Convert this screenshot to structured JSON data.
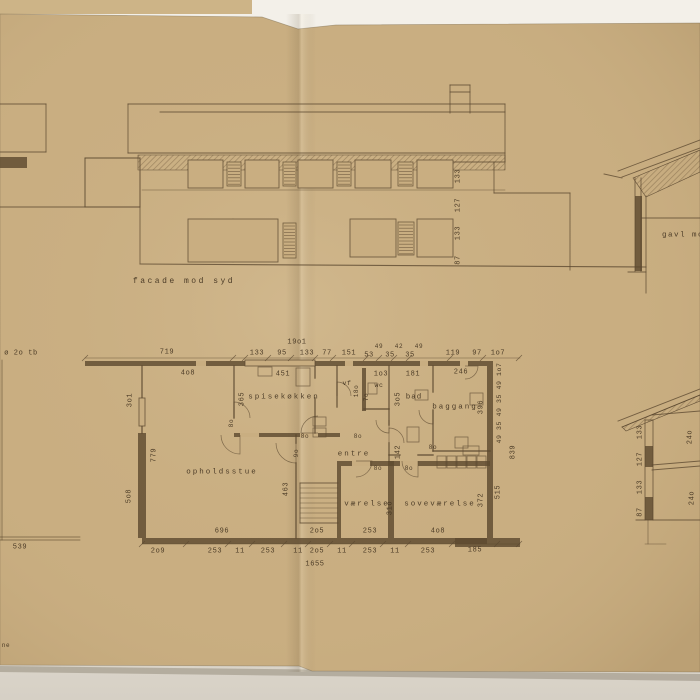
{
  "document": {
    "kind": "scanned architectural drawing on folded tracing paper",
    "captions": {
      "facade": "facade mod syd",
      "gavl": "gavl mod",
      "note_left": "ø 2o tb",
      "note_bottom_left": "ne"
    },
    "rooms": [
      "spisekøkken",
      "opholdsstue",
      "entre",
      "værelse",
      "soveværelse",
      "bad",
      "wc",
      "vf",
      "baggang"
    ]
  },
  "colors": {
    "ink": "#5b4830",
    "wall": "#5e4a2f",
    "paper": "#c9ae81",
    "paper_edge": "#b89c6f",
    "backing_strip": "#cdb487",
    "bg_top": "#f3f0e9",
    "bg_bottom": "#dcd6cb"
  },
  "labels": [
    {
      "t": "facade mod syd",
      "x": 184,
      "y": 282,
      "s": 8,
      "ls": 2.5,
      "n": "facade-caption"
    },
    {
      "t": "gavl mod",
      "x": 686,
      "y": 236,
      "s": 7.5,
      "ls": 1.5,
      "n": "gavl-caption"
    },
    {
      "t": "ø 2o tb",
      "x": 21,
      "y": 354,
      "s": 7,
      "n": "note-left"
    },
    {
      "t": "ne",
      "x": 6,
      "y": 646,
      "s": 6,
      "n": "note-bottom-left"
    },
    {
      "t": "539",
      "x": 20,
      "y": 548,
      "n": "dim-539"
    },
    {
      "t": "133",
      "x": 459,
      "y": 176,
      "r": 1
    },
    {
      "t": "127",
      "x": 459,
      "y": 205,
      "r": 1
    },
    {
      "t": "133",
      "x": 459,
      "y": 233,
      "r": 1
    },
    {
      "t": "87",
      "x": 459,
      "y": 260,
      "r": 1
    },
    {
      "t": "133",
      "x": 641,
      "y": 432,
      "r": 1
    },
    {
      "t": "127",
      "x": 641,
      "y": 459,
      "r": 1
    },
    {
      "t": "133",
      "x": 641,
      "y": 487,
      "r": 1
    },
    {
      "t": "87",
      "x": 641,
      "y": 512,
      "r": 1
    },
    {
      "t": "24o",
      "x": 691,
      "y": 437,
      "r": 1
    },
    {
      "t": "24o",
      "x": 693,
      "y": 498,
      "r": 1
    },
    {
      "t": "19o1",
      "x": 297,
      "y": 343
    },
    {
      "t": "719",
      "x": 167,
      "y": 353
    },
    {
      "t": "133",
      "x": 257,
      "y": 354
    },
    {
      "t": "95",
      "x": 282,
      "y": 354
    },
    {
      "t": "133",
      "x": 307,
      "y": 354
    },
    {
      "t": "77",
      "x": 327,
      "y": 354
    },
    {
      "t": "151",
      "x": 349,
      "y": 354
    },
    {
      "t": "53",
      "x": 369,
      "y": 356
    },
    {
      "t": "49",
      "x": 379,
      "y": 347,
      "s": 6
    },
    {
      "t": "35",
      "x": 390,
      "y": 356
    },
    {
      "t": "42",
      "x": 399,
      "y": 347,
      "s": 6
    },
    {
      "t": "35",
      "x": 410,
      "y": 356
    },
    {
      "t": "49",
      "x": 419,
      "y": 347,
      "s": 6
    },
    {
      "t": "119",
      "x": 453,
      "y": 354
    },
    {
      "t": "97",
      "x": 477,
      "y": 354
    },
    {
      "t": "1o7",
      "x": 498,
      "y": 354
    },
    {
      "t": "4o8",
      "x": 188,
      "y": 374
    },
    {
      "t": "3o1",
      "x": 131,
      "y": 400,
      "r": 1
    },
    {
      "t": "451",
      "x": 283,
      "y": 375
    },
    {
      "t": "365",
      "x": 243,
      "y": 399,
      "r": 1
    },
    {
      "t": "spisekøkken",
      "x": 284,
      "y": 398,
      "s": 7.5,
      "ls": 2,
      "n": "room-label-spisekokken"
    },
    {
      "t": "vf",
      "x": 347,
      "y": 384,
      "s": 6.5,
      "n": "room-label-vf"
    },
    {
      "t": "18o",
      "x": 357,
      "y": 391,
      "r": 1,
      "s": 6
    },
    {
      "t": "7o",
      "x": 367,
      "y": 397,
      "r": 1,
      "s": 6
    },
    {
      "t": "1o3",
      "x": 381,
      "y": 375
    },
    {
      "t": "wc",
      "x": 379,
      "y": 386,
      "s": 6.5,
      "n": "room-label-wc"
    },
    {
      "t": "181",
      "x": 413,
      "y": 375
    },
    {
      "t": "3o5",
      "x": 399,
      "y": 399,
      "r": 1
    },
    {
      "t": "bad",
      "x": 414,
      "y": 398,
      "s": 7.5,
      "ls": 1,
      "n": "room-label-bad"
    },
    {
      "t": "246",
      "x": 461,
      "y": 373
    },
    {
      "t": "baggang",
      "x": 455,
      "y": 408,
      "s": 7.5,
      "ls": 2,
      "n": "room-label-baggang"
    },
    {
      "t": "396",
      "x": 482,
      "y": 407,
      "r": 1
    },
    {
      "t": "49 35 49 35 49 1o7",
      "x": 500,
      "y": 403,
      "r": 1,
      "s": 6.5
    },
    {
      "t": "839",
      "x": 514,
      "y": 452,
      "r": 1
    },
    {
      "t": "opholdsstue",
      "x": 222,
      "y": 473,
      "s": 7.5,
      "ls": 2,
      "n": "room-label-opholdsstue"
    },
    {
      "t": "779",
      "x": 155,
      "y": 455,
      "r": 1
    },
    {
      "t": "5o8",
      "x": 130,
      "y": 496,
      "r": 1
    },
    {
      "t": "entre",
      "x": 354,
      "y": 455,
      "s": 7.5,
      "ls": 2,
      "n": "room-label-entre"
    },
    {
      "t": "9o",
      "x": 297,
      "y": 453,
      "r": 1,
      "s": 6
    },
    {
      "t": "142",
      "x": 399,
      "y": 452,
      "r": 1
    },
    {
      "t": "463",
      "x": 287,
      "y": 489,
      "r": 1
    },
    {
      "t": "værelse",
      "x": 367,
      "y": 505,
      "s": 7.5,
      "ls": 2,
      "n": "room-label-vaerelse"
    },
    {
      "t": "31o",
      "x": 391,
      "y": 508,
      "r": 1
    },
    {
      "t": "soveværelse",
      "x": 440,
      "y": 505,
      "s": 7.5,
      "ls": 2,
      "n": "room-label-sovevaerelse"
    },
    {
      "t": "372",
      "x": 482,
      "y": 500,
      "r": 1
    },
    {
      "t": "515",
      "x": 499,
      "y": 492,
      "r": 1
    },
    {
      "t": "8o",
      "x": 305,
      "y": 437,
      "s": 6
    },
    {
      "t": "8o",
      "x": 358,
      "y": 437,
      "s": 6
    },
    {
      "t": "8o",
      "x": 378,
      "y": 469,
      "s": 6
    },
    {
      "t": "8o",
      "x": 409,
      "y": 469,
      "s": 6
    },
    {
      "t": "8o",
      "x": 433,
      "y": 448,
      "s": 6
    },
    {
      "t": "8o",
      "x": 232,
      "y": 423,
      "r": 1,
      "s": 6
    },
    {
      "t": "696",
      "x": 222,
      "y": 532
    },
    {
      "t": "2o5",
      "x": 317,
      "y": 532
    },
    {
      "t": "253",
      "x": 370,
      "y": 532
    },
    {
      "t": "4o8",
      "x": 438,
      "y": 532
    },
    {
      "t": "2o9",
      "x": 158,
      "y": 552
    },
    {
      "t": "253",
      "x": 215,
      "y": 552
    },
    {
      "t": "11",
      "x": 240,
      "y": 552
    },
    {
      "t": "253",
      "x": 268,
      "y": 552
    },
    {
      "t": "11",
      "x": 298,
      "y": 552
    },
    {
      "t": "2o5",
      "x": 317,
      "y": 552
    },
    {
      "t": "11",
      "x": 342,
      "y": 552
    },
    {
      "t": "253",
      "x": 370,
      "y": 552
    },
    {
      "t": "11",
      "x": 395,
      "y": 552
    },
    {
      "t": "253",
      "x": 428,
      "y": 552
    },
    {
      "t": "185",
      "x": 475,
      "y": 551
    },
    {
      "t": "1655",
      "x": 315,
      "y": 565
    }
  ],
  "drawing": {
    "paper_path": "M0,14 L262,17 L298,29 L336,25 L700,23 L700,672 L312,671 L299,666 L0,665 Z",
    "shadow_path": "M0,666 L700,674 L700,681 L0,672 Z",
    "lines": [
      [
        0,
        104,
        46,
        104
      ],
      [
        46,
        104,
        46,
        152
      ],
      [
        0,
        152,
        46,
        152
      ],
      [
        0,
        207,
        85,
        207
      ],
      [
        128,
        104,
        505,
        104
      ],
      [
        160,
        112,
        505,
        112
      ],
      [
        128,
        104,
        128,
        153
      ],
      [
        128,
        153,
        505,
        153
      ],
      [
        85,
        158,
        140,
        158
      ],
      [
        85,
        158,
        85,
        207
      ],
      [
        140,
        158,
        140,
        263
      ],
      [
        85,
        207,
        140,
        207
      ],
      [
        505,
        104,
        505,
        162
      ],
      [
        437,
        162,
        505,
        162
      ],
      [
        494,
        162,
        494,
        193
      ],
      [
        494,
        193,
        570,
        193
      ],
      [
        570,
        193,
        570,
        270
      ],
      [
        140,
        264,
        646,
        267,
        1.1
      ],
      [
        142,
        190,
        505,
        190,
        0.6
      ],
      [
        450,
        85,
        450,
        113
      ],
      [
        470,
        85,
        470,
        113
      ],
      [
        450,
        85,
        470,
        85
      ],
      [
        450,
        92,
        470,
        92
      ],
      [
        233,
        219,
        233,
        262,
        0.7
      ],
      [
        618,
        171,
        700,
        140
      ],
      [
        622,
        177,
        700,
        148
      ],
      [
        635,
        178,
        635,
        271
      ],
      [
        641,
        178,
        641,
        271
      ],
      [
        646,
        196,
        646,
        293
      ],
      [
        641,
        218,
        700,
        218
      ],
      [
        628,
        272,
        646,
        272
      ],
      [
        604,
        174,
        622,
        178
      ],
      [
        618,
        421,
        700,
        389
      ],
      [
        622,
        427,
        700,
        395
      ],
      [
        652,
        415,
        700,
        411
      ],
      [
        652,
        465,
        700,
        461
      ],
      [
        652,
        470,
        700,
        466
      ],
      [
        636,
        520,
        700,
        520
      ],
      [
        648,
        520,
        648,
        544,
        0.6
      ],
      [
        645,
        544,
        666,
        544,
        0.6
      ],
      [
        645,
        420,
        645,
        520
      ],
      [
        653,
        420,
        653,
        520
      ],
      [
        645,
        420,
        653,
        420
      ],
      [
        2,
        360,
        2,
        540,
        0.7
      ],
      [
        0,
        537,
        80,
        537,
        0.7
      ],
      [
        0,
        540,
        80,
        540,
        0.7
      ],
      [
        85,
        358,
        520,
        358,
        0.6
      ],
      [
        142,
        544,
        520,
        544,
        0.6
      ],
      [
        300,
        483,
        338,
        483
      ],
      [
        300,
        523,
        338,
        523
      ],
      [
        300,
        483,
        300,
        523
      ],
      [
        300,
        488,
        338,
        488,
        0.6
      ],
      [
        300,
        493,
        338,
        493,
        0.6
      ],
      [
        300,
        498,
        338,
        498,
        0.6
      ],
      [
        300,
        503,
        338,
        503,
        0.6
      ],
      [
        300,
        508,
        338,
        508,
        0.6
      ],
      [
        300,
        513,
        338,
        513,
        0.6
      ],
      [
        300,
        518,
        338,
        518,
        0.6
      ],
      [
        142,
        366,
        142,
        433,
        1.4
      ],
      [
        234,
        366,
        234,
        418,
        1.4
      ],
      [
        296,
        435,
        296,
        443,
        1.4
      ],
      [
        296,
        463,
        296,
        538,
        1.4
      ],
      [
        315,
        366,
        315,
        378,
        1.4
      ],
      [
        315,
        398,
        315,
        433,
        1.4
      ],
      [
        337,
        366,
        337,
        407,
        1.4
      ],
      [
        389,
        366,
        389,
        425,
        1.4
      ],
      [
        389,
        443,
        389,
        461,
        1.4
      ],
      [
        364,
        409,
        389,
        409,
        1.4
      ],
      [
        433,
        366,
        433,
        392,
        1.4
      ],
      [
        433,
        410,
        433,
        451,
        1.4
      ],
      [
        433,
        451,
        490,
        451,
        1.4
      ],
      [
        389,
        455,
        400,
        455,
        1.4
      ],
      [
        418,
        455,
        433,
        455,
        1.4
      ],
      [
        245,
        363,
        315,
        363,
        0.6
      ]
    ],
    "walls": [
      [
        85,
        361,
        408,
        5
      ],
      [
        487,
        366,
        6,
        172
      ],
      [
        142,
        538,
        345,
        6
      ],
      [
        455,
        538,
        65,
        9
      ],
      [
        138,
        433,
        8,
        105
      ],
      [
        337,
        461,
        153,
        5
      ],
      [
        388,
        461,
        6,
        77
      ],
      [
        337,
        466,
        4,
        72
      ],
      [
        234,
        433,
        106,
        4
      ],
      [
        362,
        368,
        4,
        43
      ],
      [
        0,
        157,
        27,
        11
      ],
      [
        635,
        196,
        7,
        75
      ],
      [
        645,
        446,
        8,
        21
      ],
      [
        645,
        497,
        8,
        23
      ]
    ],
    "gaps": [
      [
        352,
        461,
        18,
        5
      ],
      [
        400,
        461,
        18,
        5
      ],
      [
        240,
        433,
        19,
        4
      ],
      [
        300,
        433,
        18,
        4
      ],
      [
        196,
        361,
        10,
        5
      ],
      [
        345,
        361,
        8,
        5
      ],
      [
        420,
        361,
        8,
        5
      ],
      [
        460,
        361,
        8,
        5
      ]
    ],
    "boxes": [
      [
        188,
        160,
        35,
        28
      ],
      [
        245,
        160,
        34,
        28
      ],
      [
        298,
        160,
        35,
        28
      ],
      [
        355,
        160,
        36,
        28
      ],
      [
        417,
        160,
        36,
        28
      ],
      [
        188,
        219,
        90,
        43
      ],
      [
        350,
        219,
        46,
        38
      ],
      [
        417,
        219,
        36,
        38
      ],
      [
        245,
        360,
        70,
        6
      ],
      [
        139,
        398,
        6,
        28
      ]
    ],
    "louvers": [
      [
        227,
        162,
        14,
        24
      ],
      [
        283,
        162,
        13,
        24
      ],
      [
        337,
        162,
        14,
        24
      ],
      [
        398,
        162,
        15,
        24
      ],
      [
        283,
        223,
        13,
        35
      ],
      [
        398,
        222,
        16,
        33
      ]
    ],
    "furn": [
      [
        296,
        368,
        14,
        18
      ],
      [
        258,
        367,
        14,
        9
      ],
      [
        415,
        390,
        13,
        10
      ],
      [
        407,
        427,
        12,
        15
      ],
      [
        470,
        393,
        13,
        12
      ],
      [
        455,
        437,
        13,
        11
      ],
      [
        313,
        417,
        13,
        9
      ],
      [
        313,
        428,
        13,
        9
      ],
      [
        368,
        383,
        9,
        11
      ],
      [
        463,
        446,
        16,
        9
      ],
      [
        437,
        456,
        9,
        12
      ],
      [
        447,
        456,
        9,
        12
      ],
      [
        457,
        456,
        9,
        12
      ],
      [
        467,
        456,
        9,
        12
      ],
      [
        477,
        456,
        9,
        12
      ],
      [
        85,
        158,
        55,
        49
      ]
    ],
    "hatches": [
      [
        [
          138,
          155
        ],
        [
          505,
          155
        ],
        [
          505,
          170
        ],
        [
          138,
          170
        ]
      ],
      [
        [
          633,
          178
        ],
        [
          700,
          150
        ],
        [
          700,
          172
        ],
        [
          646,
          197
        ]
      ],
      [
        [
          622,
          427
        ],
        [
          700,
          395
        ],
        [
          700,
          401
        ],
        [
          626,
          431
        ]
      ]
    ],
    "arcs": [
      [
        240,
        435,
        19,
        90,
        180
      ],
      [
        296,
        443,
        20,
        90,
        180
      ],
      [
        318,
        433,
        17,
        180,
        270
      ],
      [
        337,
        396,
        14,
        270,
        360
      ],
      [
        389,
        420,
        13,
        90,
        180
      ],
      [
        389,
        443,
        15,
        270,
        360
      ],
      [
        356,
        461,
        16,
        0,
        90
      ],
      [
        418,
        461,
        16,
        90,
        180
      ],
      [
        433,
        410,
        14,
        90,
        180
      ],
      [
        465,
        366,
        13,
        0,
        90
      ],
      [
        234,
        418,
        16,
        270,
        360
      ]
    ],
    "ticks": {
      "top": {
        "y": 358,
        "xs": [
          85,
          233,
          245,
          268,
          291,
          315,
          333,
          366,
          379,
          394,
          409,
          450,
          483,
          519
        ]
      },
      "bottom": {
        "y": 544,
        "xs": [
          142,
          186,
          228,
          252,
          284,
          308,
          330,
          352,
          383,
          408,
          452,
          497,
          519
        ]
      }
    }
  }
}
